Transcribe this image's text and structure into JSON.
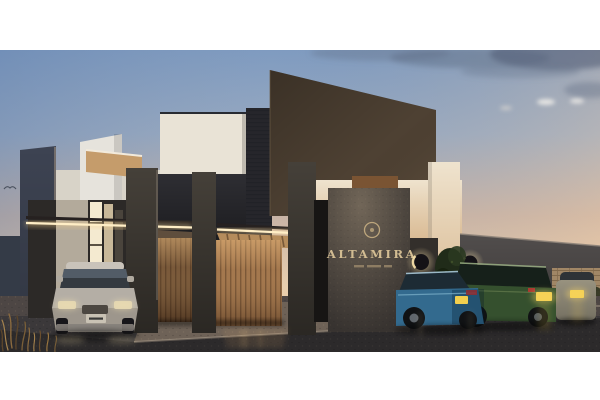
{
  "scene": {
    "description": "Dusk architectural rendering of a modern gated residential complex with an entrance pergola, monument sign and parked cars",
    "time_of_day": "dusk"
  },
  "sign": {
    "name": "ALTAMIRA"
  },
  "colors": {
    "letterbox": "#ffffff",
    "sky_top": "#7f9bc0",
    "sky_horizon": "#eac9a2",
    "facade_brown": "#4e4133",
    "wall_white": "#e9e3d6",
    "wall_cream": "#e6d4b4",
    "panel_charcoal": "#2e2e33",
    "wall_slate": "#3d4352",
    "tan_wall": "#c59c6b",
    "pillar_concrete": "#454039",
    "sign_block": "#4a4440",
    "sign_text": "#d2bc92",
    "wood_gate": "#9c7048",
    "wood_gate_dark": "#6e4f33",
    "led_strip": "#ffeec6",
    "sconce_glow": "#f6dfa8",
    "gray_wall": "#514d4c",
    "masonry_wall": "#a18766",
    "asphalt": "#3b383a",
    "apron_concrete": "#6e6257",
    "car_silver": "#b4aea5",
    "car_blue": "#336a8e",
    "car_green": "#35502e",
    "car_far_silver": "#98927f",
    "plate_yellow": "#f2cf4e",
    "shrub_green": "#202b19",
    "grass_dry": "#8a6a3f"
  }
}
